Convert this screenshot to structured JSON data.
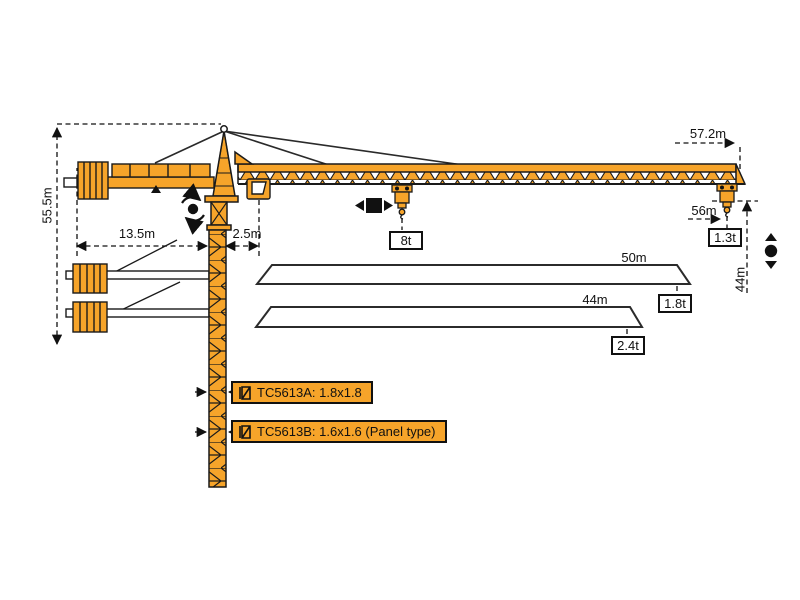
{
  "colors": {
    "crane_orange": "#F6A42A",
    "outline": "#1A1A1A"
  },
  "dimensions": {
    "hook_height": "55.5m",
    "counter_jib_radius": "13.5m",
    "mast_to_jib_offset": "2.5m",
    "max_tip_radius": "57.2m",
    "tip_working_radius": "56m",
    "tip_hook_height": "44m"
  },
  "loads": {
    "max_load": "8t",
    "tip_load": "1.3t"
  },
  "jib_options": [
    {
      "length": "50m",
      "tip_load": "1.8t"
    },
    {
      "length": "44m",
      "tip_load": "2.4t"
    }
  ],
  "models": [
    {
      "label": "TC5613A:  1.8x1.8"
    },
    {
      "label": "TC5613B:  1.6x1.6  (Panel type)"
    }
  ],
  "icons": {
    "slewing": "slewing-rotation-icon",
    "trolley": "trolley-travel-icon",
    "hoist": "hook-hoist-icon",
    "mast_section": "mast-section-icon"
  }
}
